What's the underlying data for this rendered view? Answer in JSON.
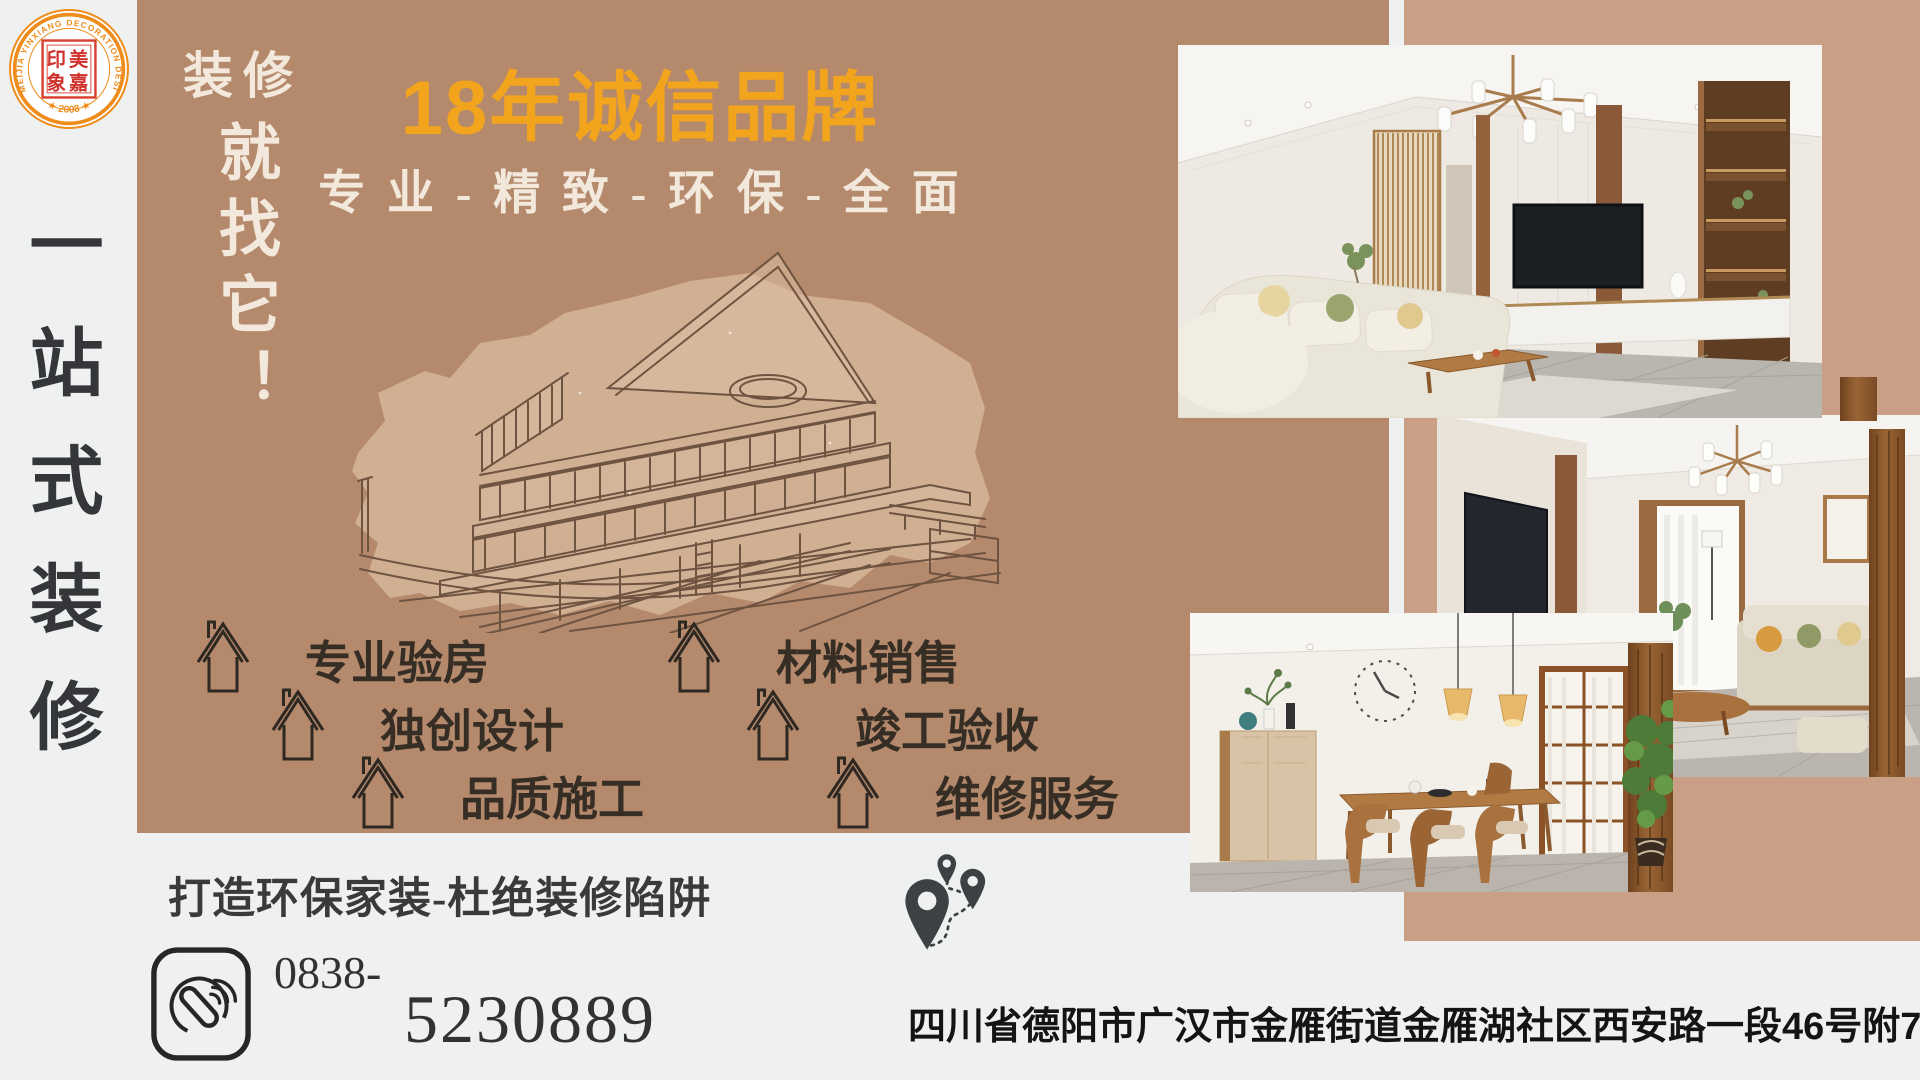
{
  "colors": {
    "page_bg": "#eef1f0",
    "panel_brown": "#b5896c",
    "panel_right_brown": "#c9a085",
    "accent_orange": "#f2a41d",
    "cream_text": "#f2e9dc",
    "dark_text": "#362e25",
    "logo_orange": "#ee8c1c",
    "logo_red": "#d4332e"
  },
  "logo": {
    "ring_text": "MEIJIA YINXIANG DECORATION DESIGN CO.,LTD",
    "year_text": "★ 2008 ★",
    "seal_row1": "印美",
    "seal_row2": "象嘉"
  },
  "side_banner": {
    "text": "一站式装修"
  },
  "intro": {
    "kicker": "装修",
    "slogan_vertical": "就找它！"
  },
  "headline": {
    "title": "18年诚信品牌",
    "subtitle": "专 业 - 精 致 - 环 保 - 全 面"
  },
  "services": [
    {
      "label": "专业验房"
    },
    {
      "label": "材料销售"
    },
    {
      "label": "独创设计"
    },
    {
      "label": "竣工验收"
    },
    {
      "label": "品质施工"
    },
    {
      "label": "维修服务"
    }
  ],
  "footer": {
    "slogan": "打造环保家装-杜绝装修陷阱",
    "phone_prefix": "0838-",
    "phone_number": "5230889",
    "address": "四川省德阳市广汉市金雁街道金雁湖社区西安路一段46号附7号"
  }
}
